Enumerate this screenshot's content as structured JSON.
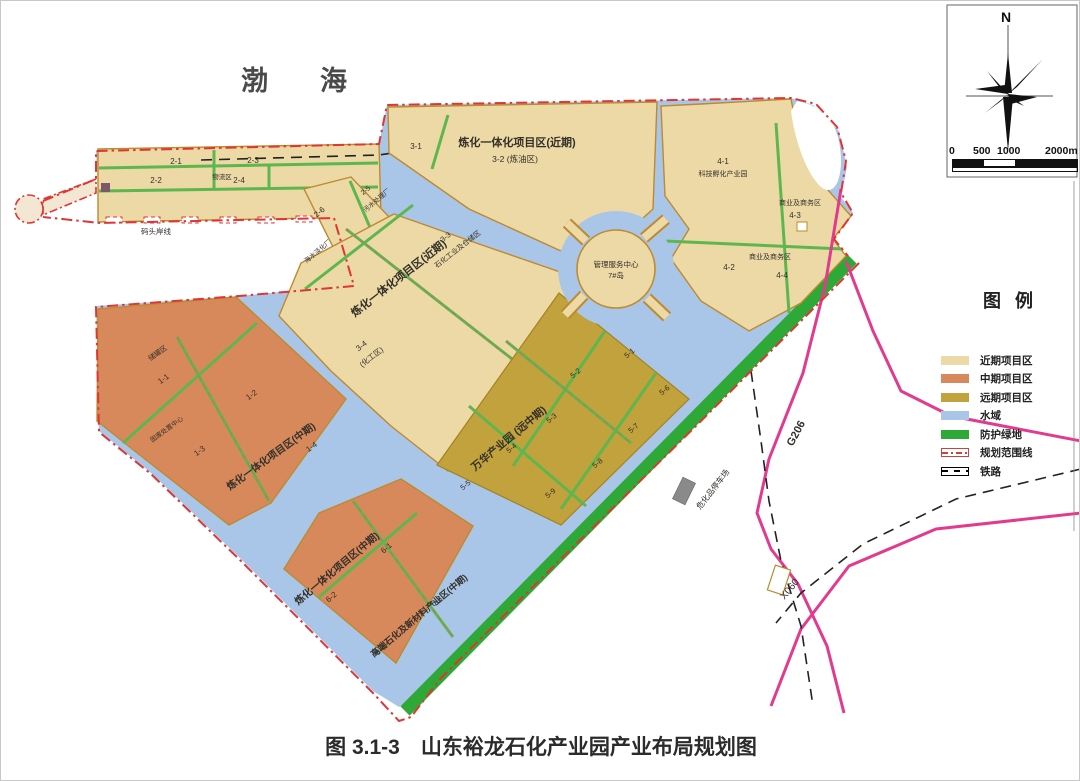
{
  "title": "图 3.1-3　山东裕龙石化产业园产业布局规划图",
  "sea_label": "渤海",
  "compass": {
    "north_label": "N"
  },
  "scale_bar": {
    "ticks": [
      "0",
      "500",
      "1000",
      "2000m"
    ]
  },
  "legend": {
    "title": "图例",
    "items": [
      {
        "label": "近期项目区",
        "type": "fill",
        "color": "#ecd9a6"
      },
      {
        "label": "中期项目区",
        "type": "fill",
        "color": "#d8895b"
      },
      {
        "label": "远期项目区",
        "type": "fill",
        "color": "#c2a23c"
      },
      {
        "label": "水域",
        "type": "fill",
        "color": "#a9c6e8"
      },
      {
        "label": "防护绿地",
        "type": "fill",
        "color": "#2ea836"
      },
      {
        "label": "规划范围线",
        "type": "boundary",
        "color": "#e03535"
      },
      {
        "label": "铁路",
        "type": "railway",
        "color": "#000000"
      }
    ]
  },
  "map_labels": [
    {
      "t": "2-1",
      "x": 175,
      "y": 163,
      "r": 0,
      "s": 8
    },
    {
      "t": "2-3",
      "x": 252,
      "y": 162,
      "r": 0,
      "s": 8
    },
    {
      "t": "2-2",
      "x": 155,
      "y": 182,
      "r": 0,
      "s": 8
    },
    {
      "t": "物流区",
      "x": 221,
      "y": 178,
      "r": 0,
      "s": 6.5
    },
    {
      "t": "2-4",
      "x": 238,
      "y": 182,
      "r": 0,
      "s": 8
    },
    {
      "t": "码头岸线",
      "x": 155,
      "y": 233,
      "r": 0,
      "s": 7.5
    },
    {
      "t": "2-5",
      "x": 366,
      "y": 191,
      "r": -40,
      "s": 7
    },
    {
      "t": "污水处理厂",
      "x": 377,
      "y": 201,
      "r": -40,
      "s": 6.5
    },
    {
      "t": "2-6",
      "x": 320,
      "y": 213,
      "r": -40,
      "s": 8
    },
    {
      "t": "海水淡化厂",
      "x": 318,
      "y": 252,
      "r": -40,
      "s": 6.5
    },
    {
      "t": "3-1",
      "x": 415,
      "y": 148,
      "r": 0,
      "s": 8
    },
    {
      "t": "炼化一体化项目区(近期)",
      "x": 516,
      "y": 145,
      "r": 0,
      "s": 11,
      "b": 1
    },
    {
      "t": "3-2  (炼油区)",
      "x": 514,
      "y": 161,
      "r": 0,
      "s": 8.5
    },
    {
      "t": "管理服务中心",
      "x": 615,
      "y": 266,
      "r": 0,
      "s": 7.5
    },
    {
      "t": "7#岛",
      "x": 615,
      "y": 277,
      "r": 0,
      "s": 7.5
    },
    {
      "t": "4-1",
      "x": 722,
      "y": 163,
      "r": 0,
      "s": 8
    },
    {
      "t": "科技孵化产业园",
      "x": 722,
      "y": 175,
      "r": 0,
      "s": 7
    },
    {
      "t": "商业及商务区",
      "x": 799,
      "y": 204,
      "r": 0,
      "s": 7
    },
    {
      "t": "4-3",
      "x": 794,
      "y": 217,
      "r": 0,
      "s": 8
    },
    {
      "t": "4-2",
      "x": 728,
      "y": 269,
      "r": 0,
      "s": 8
    },
    {
      "t": "商业及商务区",
      "x": 769,
      "y": 258,
      "r": 0,
      "s": 7
    },
    {
      "t": "4-4",
      "x": 781,
      "y": 277,
      "r": 0,
      "s": 8
    },
    {
      "t": "炼化一体化项目区(近期)",
      "x": 400,
      "y": 280,
      "r": -38,
      "s": 11,
      "b": 1
    },
    {
      "t": "3-3",
      "x": 446,
      "y": 238,
      "r": -38,
      "s": 7.5
    },
    {
      "t": "石化工业及仓储区",
      "x": 458,
      "y": 250,
      "r": -38,
      "s": 7
    },
    {
      "t": "3-4",
      "x": 362,
      "y": 347,
      "r": -38,
      "s": 8
    },
    {
      "t": "(化工区)",
      "x": 372,
      "y": 358,
      "r": -38,
      "s": 7.5
    },
    {
      "t": "储罐区",
      "x": 158,
      "y": 354,
      "r": -36,
      "s": 7
    },
    {
      "t": "1-1",
      "x": 164,
      "y": 380,
      "r": -36,
      "s": 8
    },
    {
      "t": "1-2",
      "x": 252,
      "y": 396,
      "r": -36,
      "s": 8
    },
    {
      "t": "固废处置中心",
      "x": 167,
      "y": 430,
      "r": -36,
      "s": 6.5
    },
    {
      "t": "1-3",
      "x": 200,
      "y": 452,
      "r": -36,
      "s": 8
    },
    {
      "t": "炼化一体化项目区(中期)",
      "x": 272,
      "y": 458,
      "r": -36,
      "s": 10,
      "b": 1
    },
    {
      "t": "1-4",
      "x": 312,
      "y": 448,
      "r": -36,
      "s": 8
    },
    {
      "t": "炼化一体化项目区(中期)",
      "x": 338,
      "y": 570,
      "r": -40,
      "s": 10,
      "b": 1
    },
    {
      "t": "6-1",
      "x": 387,
      "y": 549,
      "r": -40,
      "s": 8
    },
    {
      "t": "6-2",
      "x": 332,
      "y": 598,
      "r": -40,
      "s": 8
    },
    {
      "t": "高端石化及新材料产业区(中期)",
      "x": 420,
      "y": 617,
      "r": -40,
      "s": 9,
      "b": 1
    },
    {
      "t": "6-3",
      "x": 437,
      "y": 602,
      "r": -40,
      "s": 8
    },
    {
      "t": "6-4",
      "x": 381,
      "y": 651,
      "r": -40,
      "s": 8
    },
    {
      "t": "万华产业园 (远中期)",
      "x": 510,
      "y": 440,
      "r": -40,
      "s": 10.5,
      "b": 1
    },
    {
      "t": "5-1",
      "x": 630,
      "y": 354,
      "r": -40,
      "s": 7.5
    },
    {
      "t": "5-2",
      "x": 576,
      "y": 374,
      "r": -40,
      "s": 7.5
    },
    {
      "t": "5-3",
      "x": 552,
      "y": 419,
      "r": -40,
      "s": 7.5
    },
    {
      "t": "5-4",
      "x": 512,
      "y": 449,
      "r": -40,
      "s": 7.5
    },
    {
      "t": "5-5",
      "x": 466,
      "y": 486,
      "r": -40,
      "s": 7.5
    },
    {
      "t": "5-6",
      "x": 665,
      "y": 391,
      "r": -40,
      "s": 7.5
    },
    {
      "t": "5-7",
      "x": 634,
      "y": 429,
      "r": -40,
      "s": 7.5
    },
    {
      "t": "5-8",
      "x": 598,
      "y": 464,
      "r": -40,
      "s": 7.5
    },
    {
      "t": "5-9",
      "x": 551,
      "y": 494,
      "r": -40,
      "s": 7.5
    },
    {
      "t": "危化品停车场",
      "x": 714,
      "y": 490,
      "r": -52,
      "s": 8
    },
    {
      "t": "G206",
      "x": 798,
      "y": 434,
      "r": -62,
      "s": 11,
      "b": 1
    },
    {
      "t": "X060",
      "x": 791,
      "y": 590,
      "r": -50,
      "s": 10
    }
  ]
}
